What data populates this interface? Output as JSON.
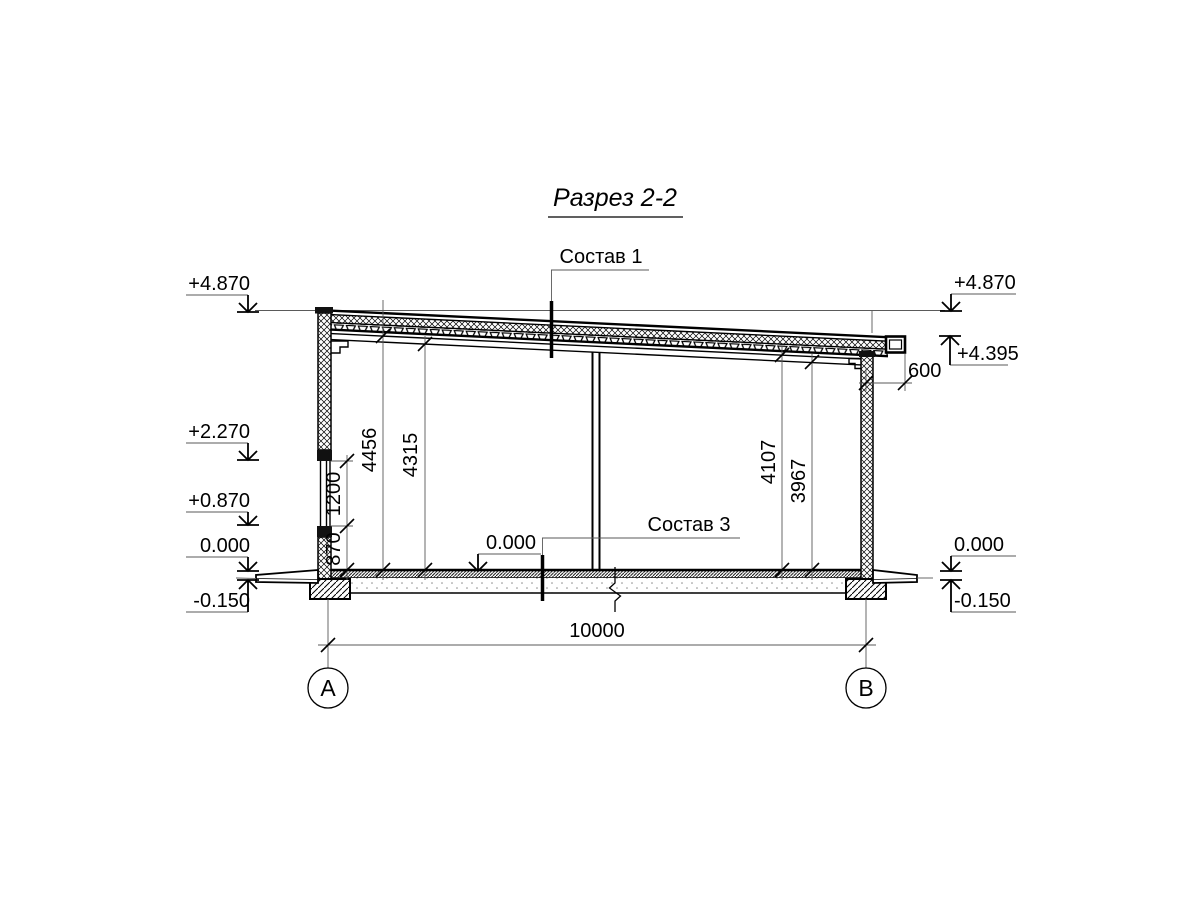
{
  "title": "Разрез 2-2",
  "leaders": {
    "sostav1": "Состав 1",
    "sostav3": "Состав 3"
  },
  "elevations": {
    "left_top": "+4.870",
    "left_mid": "+2.270",
    "left_low": "+0.870",
    "left_zero": "0.000",
    "left_minus": "-0.150",
    "right_top": "+4.870",
    "right_eave": "+4.395",
    "right_zero": "0.000",
    "right_minus": "-0.150",
    "floor_zero": "0.000"
  },
  "dims": {
    "sill_height": "870",
    "window_height": "1200",
    "clear_left_top": "4456",
    "clear_left_bottom": "4315",
    "clear_right_top": "4107",
    "clear_right_bottom": "3967",
    "overhang": "600",
    "span": "10000"
  },
  "axes": {
    "a": "А",
    "b": "В"
  },
  "colors": {
    "line": "#000000",
    "thin_line": "#5a5a5a",
    "paper": "#ffffff"
  }
}
